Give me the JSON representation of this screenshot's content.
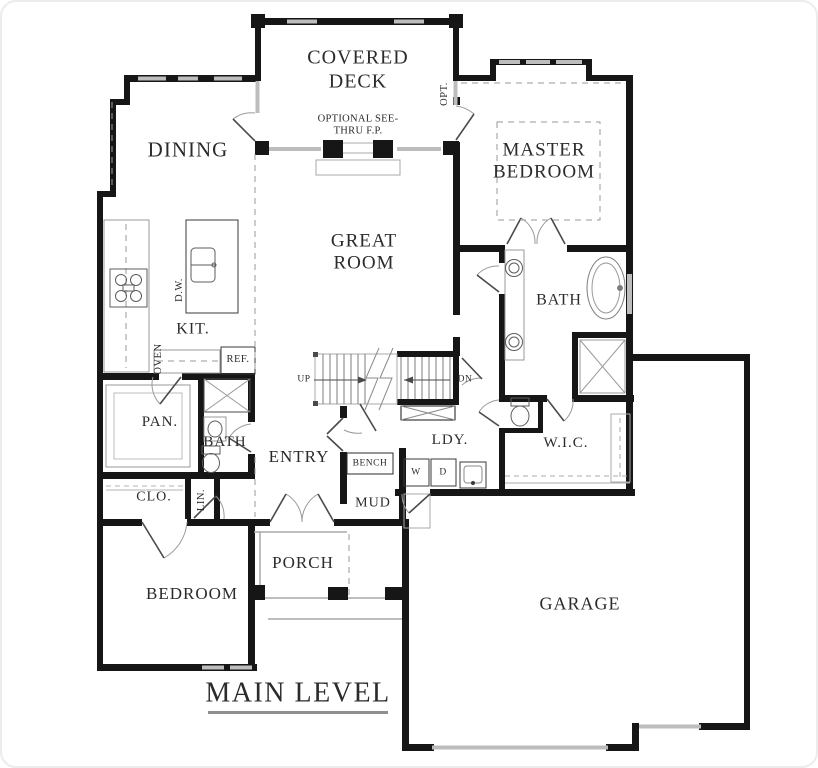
{
  "plan": {
    "title": "MAIN LEVEL",
    "labels": {
      "covered_deck": "COVERED DECK",
      "optional_fp": "OPTIONAL SEE-THRU F.P.",
      "opt": "OPT.",
      "dining": "DINING",
      "master_bedroom": "MASTER BEDROOM",
      "great_room": "GREAT ROOM",
      "master_bath": "BATH",
      "kitchen": "KIT.",
      "dishwasher": "D.W.",
      "oven": "OVEN",
      "refrigerator": "REF.",
      "stairs_up": "UP",
      "stairs_down": "DN",
      "pantry": "PAN.",
      "bath2": "BATH",
      "entry": "ENTRY",
      "bench": "BENCH",
      "laundry": "LDY.",
      "washer": "W",
      "dryer": "D",
      "wic": "W.I.C.",
      "closet": "CLO.",
      "linen": "LIN.",
      "mud": "MUD",
      "bedroom": "BEDROOM",
      "porch": "PORCH",
      "garage": "GARAGE"
    },
    "colors": {
      "wall": "#161616",
      "window": "#bdbdbd",
      "light_line": "#a8a8a8",
      "fixture_line": "#6f6f6f",
      "dash_line": "#9a9a9a",
      "text": "#2b2b2b",
      "background": "#ffffff"
    }
  }
}
